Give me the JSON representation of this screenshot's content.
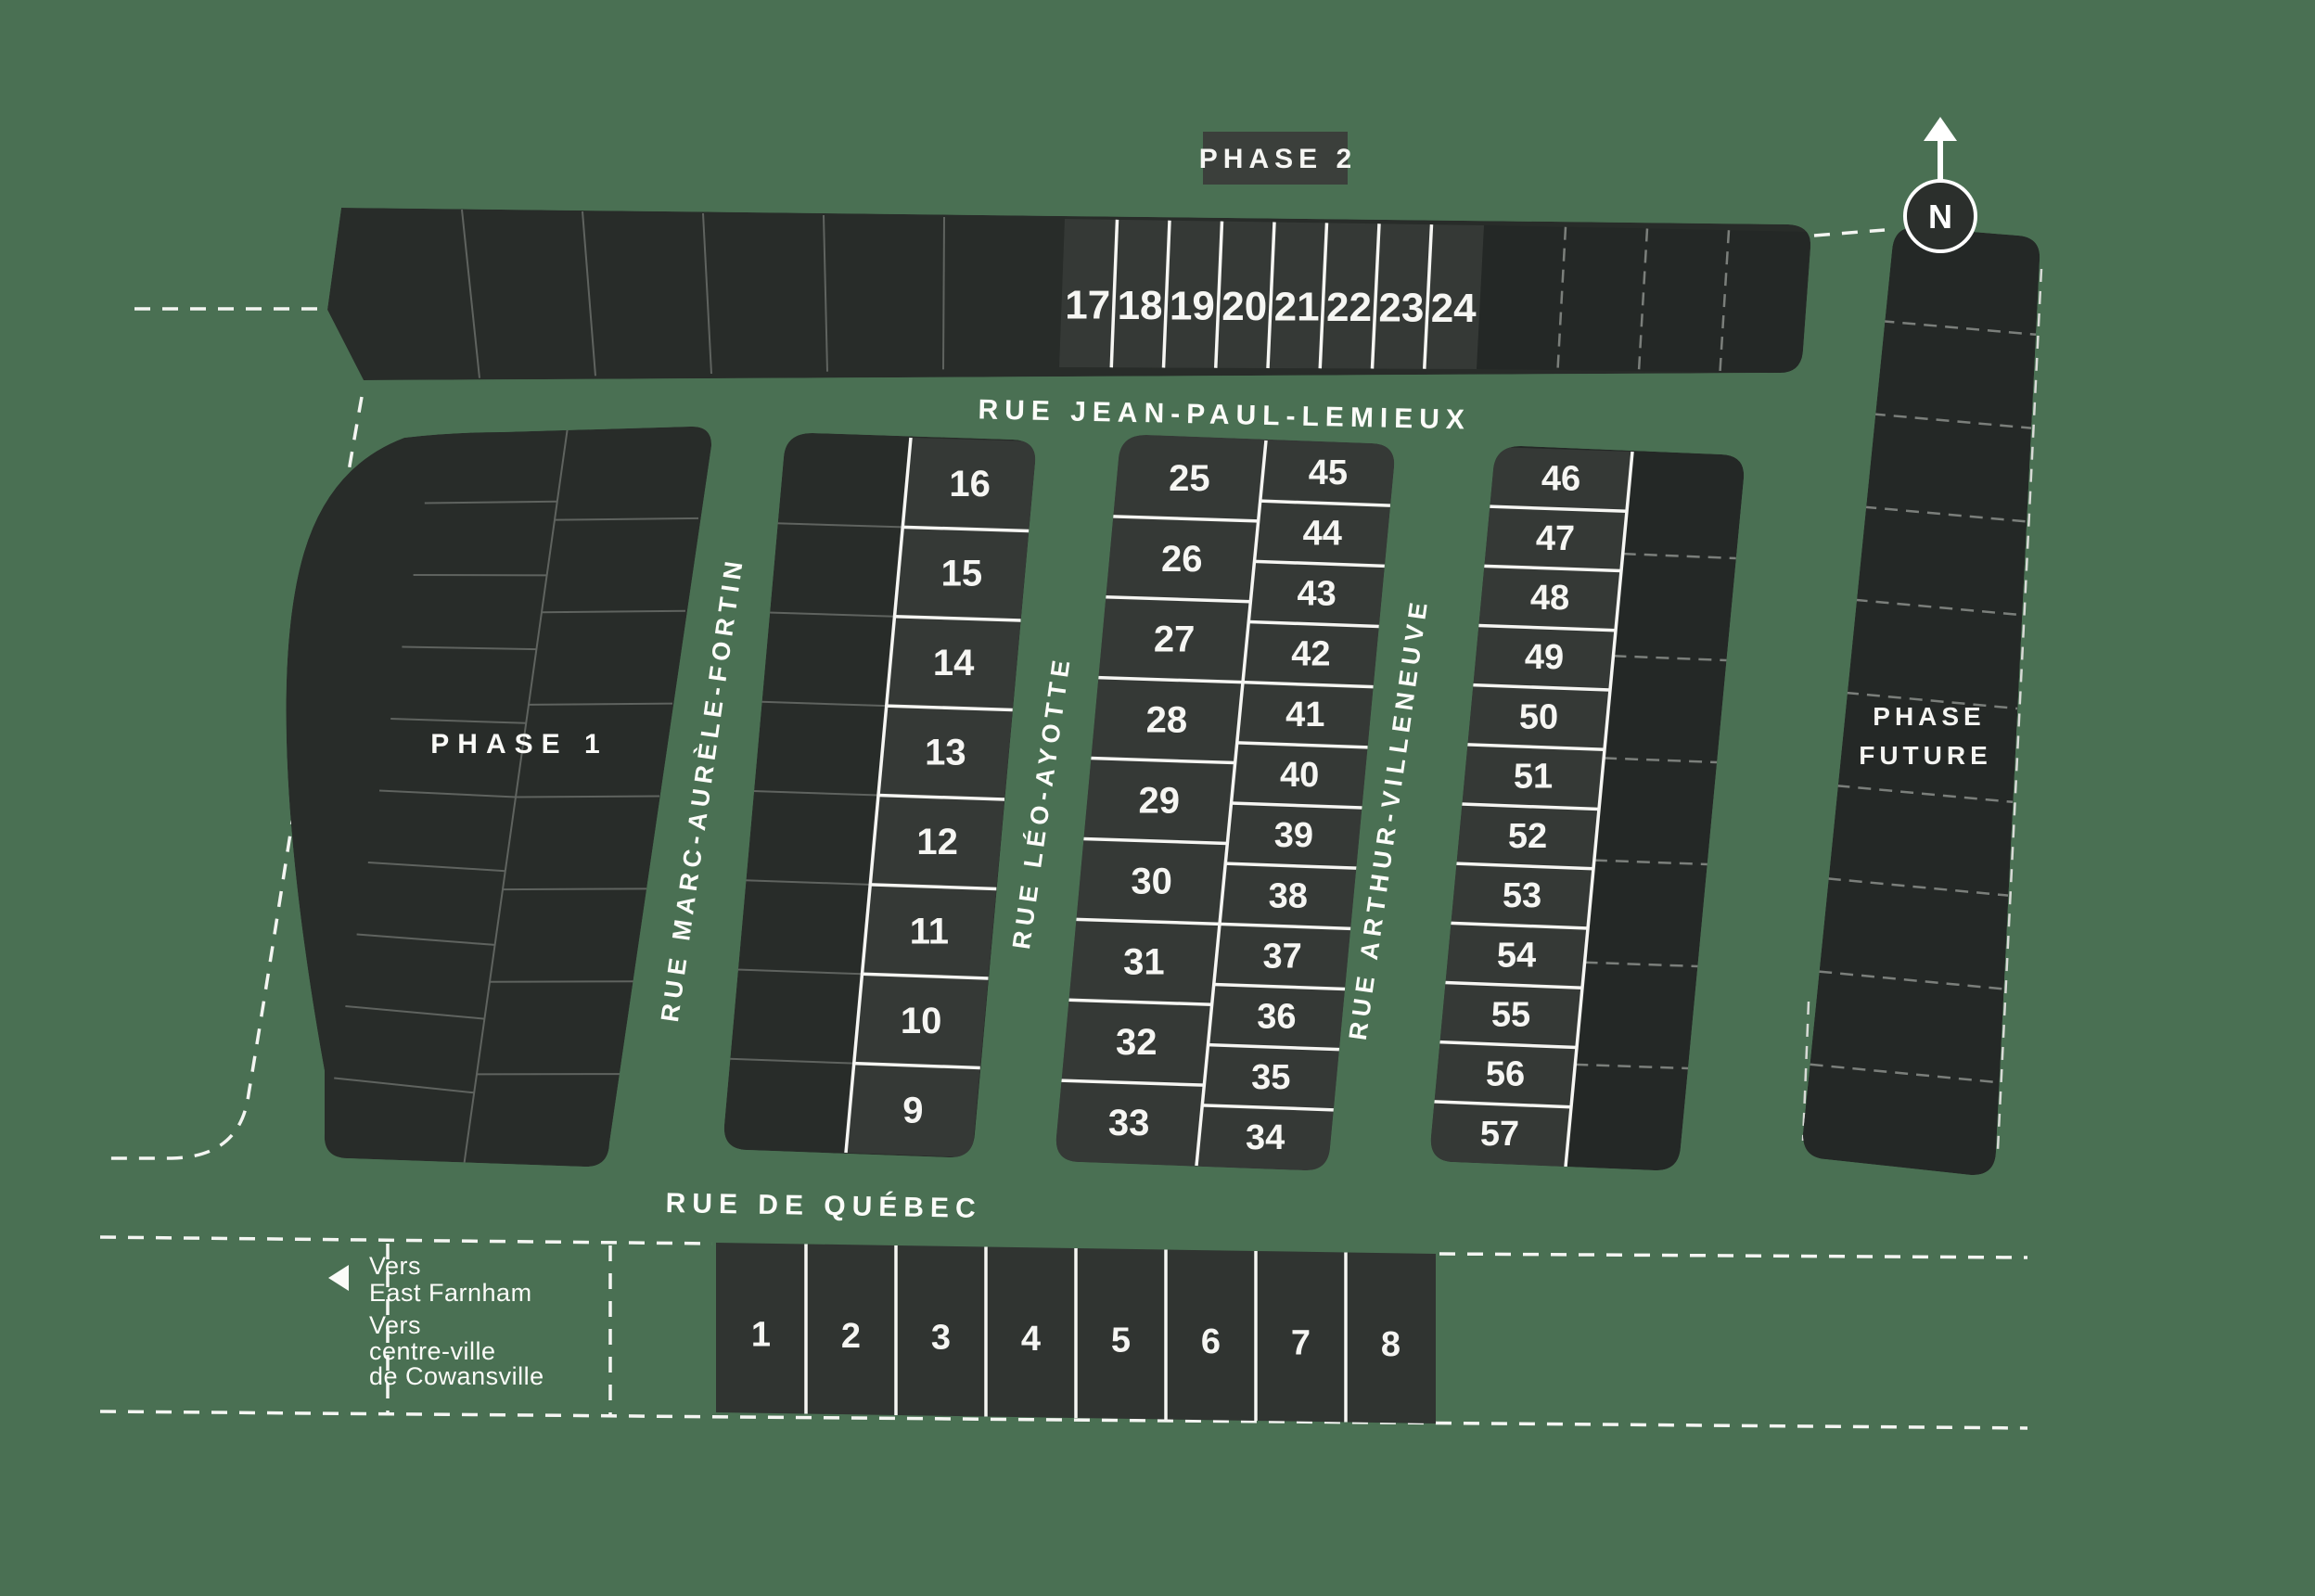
{
  "map": {
    "labels": {
      "phase1": "PHASE 1",
      "phase2": "PHASE 2",
      "phase_future": [
        "PHASE",
        "FUTURE"
      ],
      "north": "N"
    },
    "streets": {
      "jean_paul_lemieux": "RUE JEAN-PAUL-LEMIEUX",
      "marc_aurele_fortin": "RUE MARC-AURÈLE-FORTIN",
      "leo_ayotte": "RUE LÉO-AYOTTE",
      "arthur_villeneuve": "RUE ARTHUR-VILLENEUVE",
      "de_quebec": "RUE DE QUÉBEC"
    },
    "directions": {
      "east_farnham": [
        "Vers",
        "East Farnham"
      ],
      "cowansville": [
        "Vers",
        "centre-ville",
        "de Cowansville"
      ]
    },
    "lots": {
      "bottom_row": [
        "1",
        "2",
        "3",
        "4",
        "5",
        "6",
        "7",
        "8"
      ],
      "west_column_top_to_bottom": [
        "16",
        "15",
        "14",
        "13",
        "12",
        "11",
        "10",
        "9"
      ],
      "phase2_row": [
        "17",
        "18",
        "19",
        "20",
        "21",
        "22",
        "23",
        "24"
      ],
      "central_west_top_to_bottom": [
        "25",
        "26",
        "27",
        "28",
        "29",
        "30",
        "31",
        "32",
        "33"
      ],
      "central_east_top_to_bottom": [
        "45",
        "44",
        "43",
        "42",
        "41",
        "40",
        "39",
        "38",
        "37",
        "36",
        "35",
        "34"
      ],
      "east_column_top_to_bottom": [
        "46",
        "47",
        "48",
        "49",
        "50",
        "51",
        "52",
        "53",
        "54",
        "55",
        "56",
        "57"
      ]
    },
    "colors": {
      "background": "#4a7053",
      "lot_fill": "#353936",
      "bottom_fill": "#303431",
      "lot_dark": "#282c29",
      "lot_future": "#242826",
      "divider_white": "#f6f6f3",
      "divider_gray": "#5f635f",
      "divider_dashed": "#7b7f7b",
      "road_dash": "#f4f5f2",
      "badge_bg": "#3b3f3b",
      "text": "#fbfbf8"
    }
  }
}
